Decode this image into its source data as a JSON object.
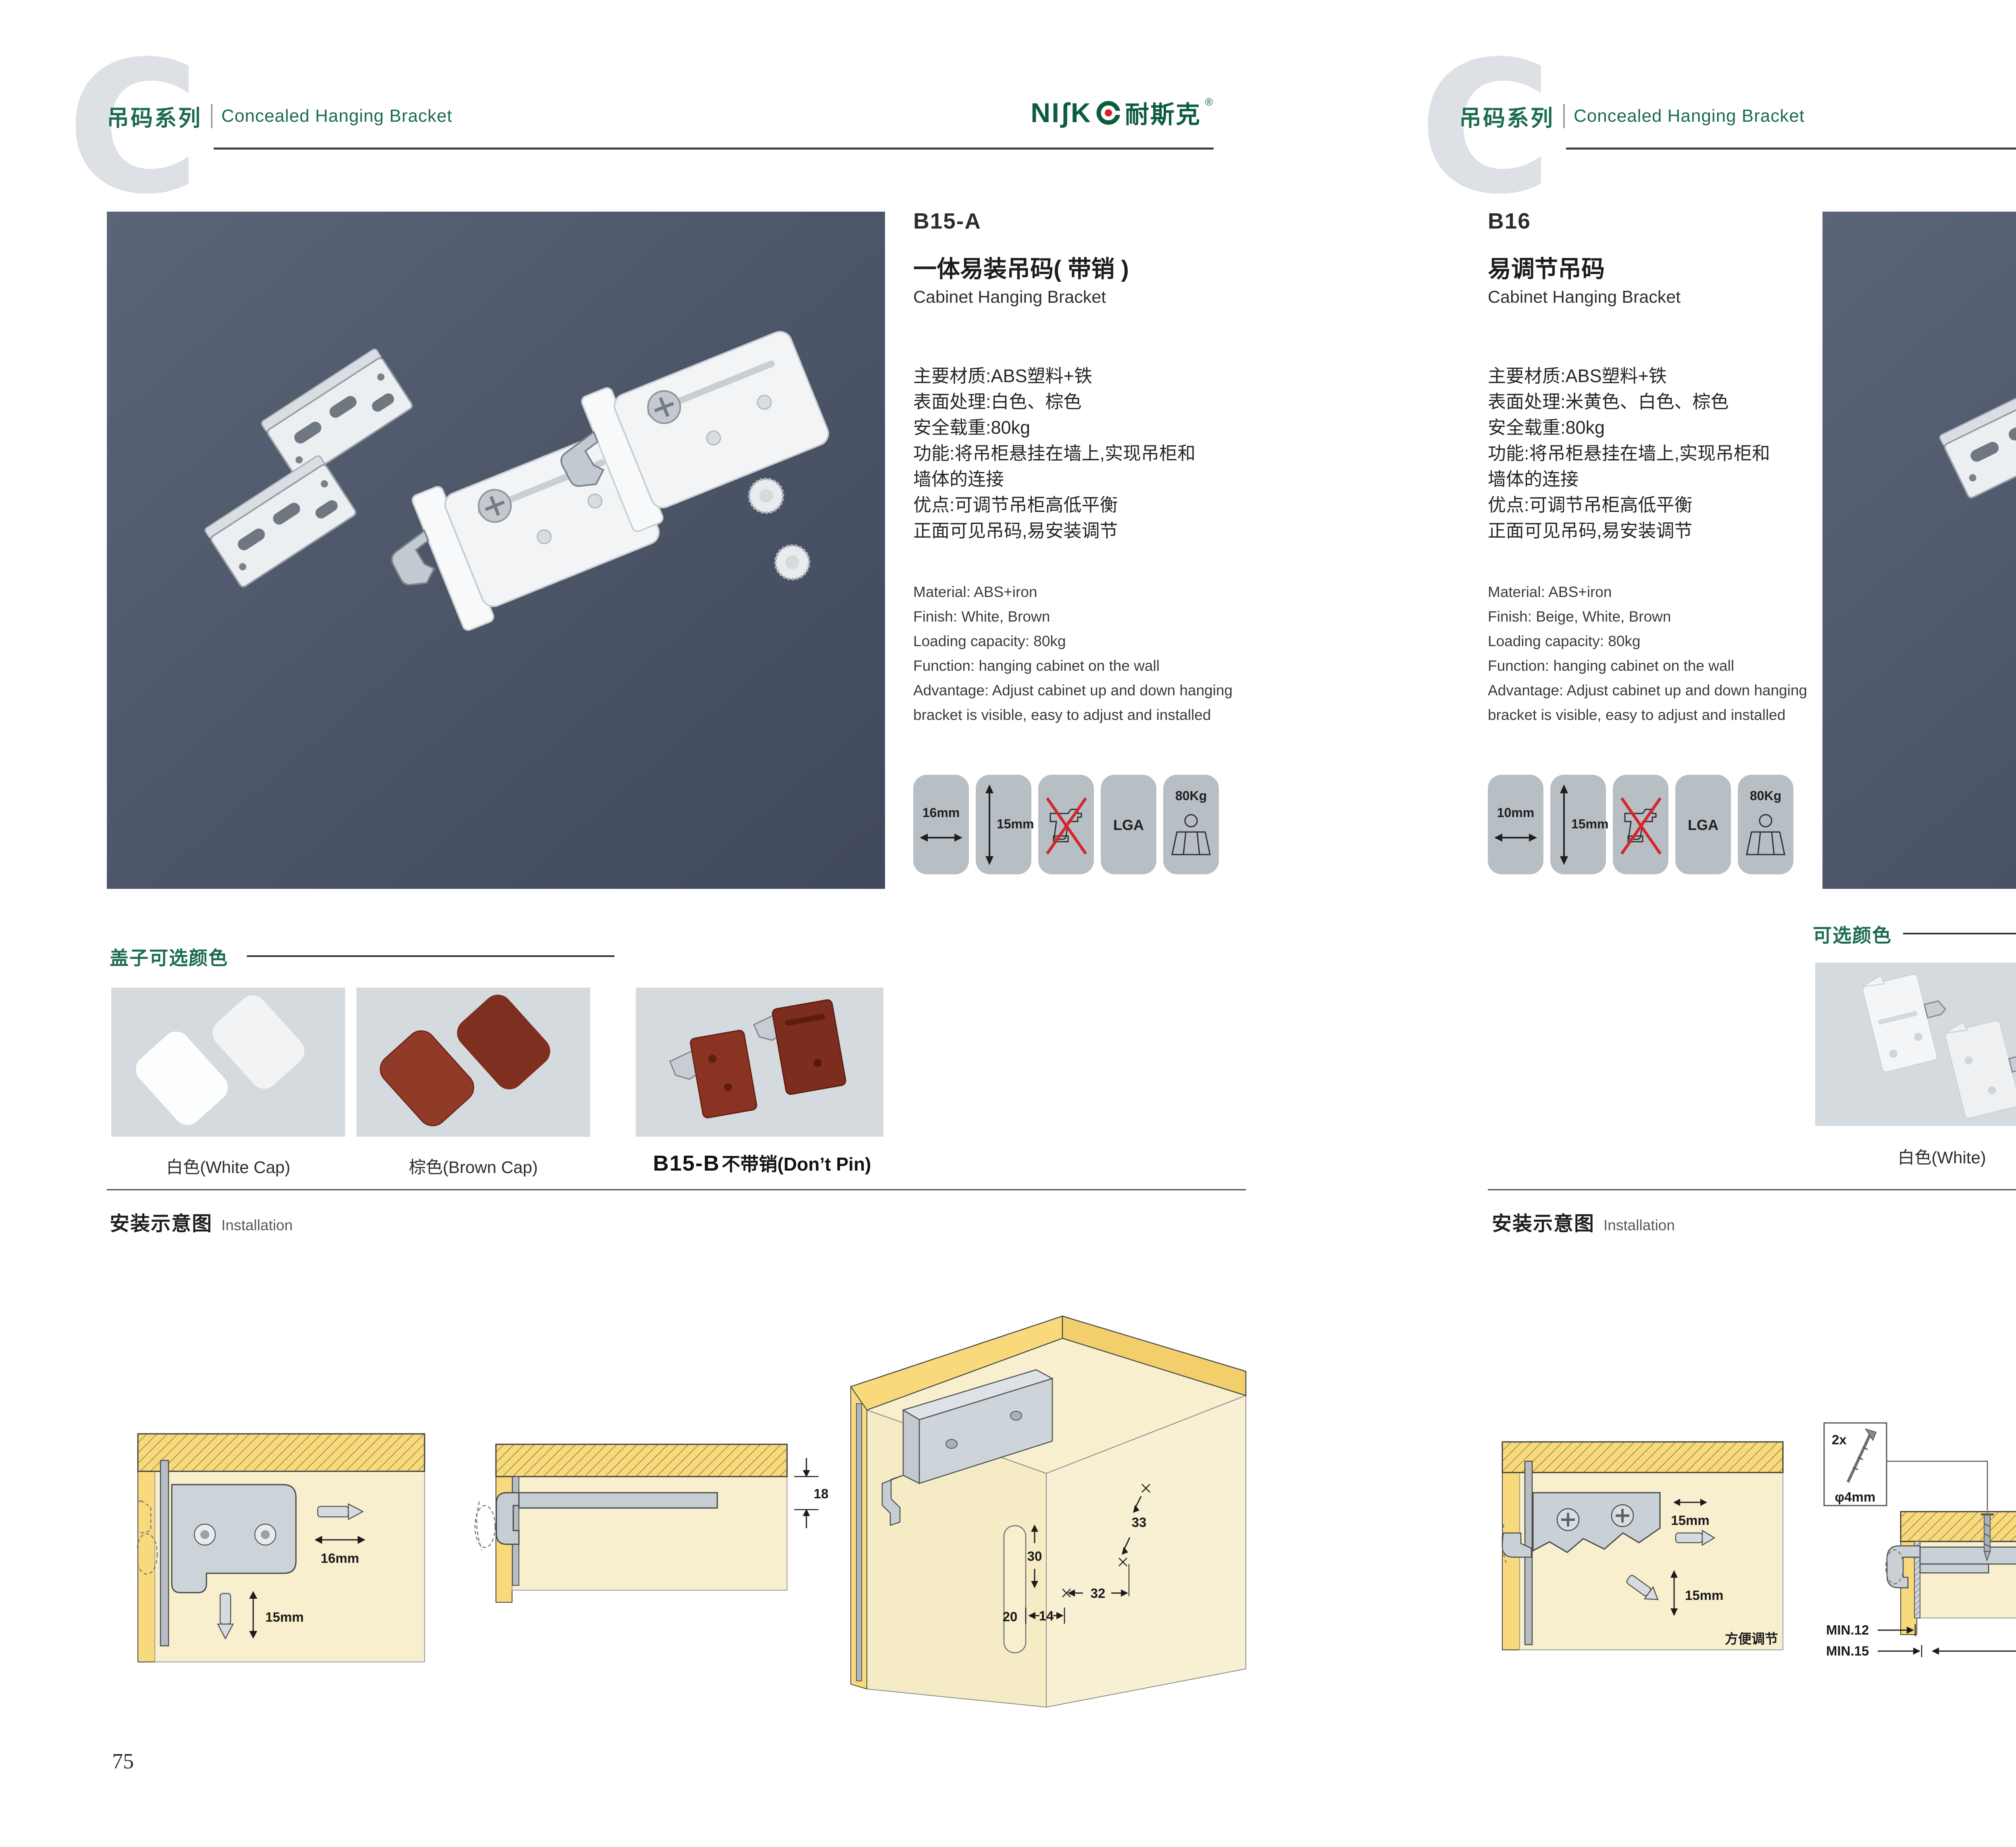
{
  "brand": {
    "logo_word": "NIʃK",
    "logo_cjk": "耐斯克",
    "logo_reg": "®"
  },
  "left_page": {
    "header": {
      "series_cn": "吊码系列",
      "series_en": "Concealed Hanging Bracket",
      "watermark": "C"
    },
    "product": {
      "code": "B15-A",
      "name_cn": "一体易装吊码( 带销 )",
      "name_en": "Cabinet Hanging Bracket",
      "specs_cn": [
        "主要材质:ABS塑料+铁",
        "表面处理:白色、棕色",
        "安全载重:80kg",
        "功能:将吊柜悬挂在墙上,实现吊柜和",
        "墙体的连接",
        "优点:可调节吊柜高低平衡",
        "正面可见吊码,易安装调节"
      ],
      "specs_en": [
        "Material: ABS+iron",
        "Finish: White, Brown",
        "Loading capacity: 80kg",
        "Function: hanging cabinet on the wall",
        "Advantage: Adjust cabinet up and down hanging",
        "bracket is visible, easy to adjust and installed"
      ]
    },
    "icons": {
      "width": "16mm",
      "height": "15mm",
      "cert": "LGA",
      "load": "80Kg"
    },
    "colors_section": {
      "title": "盖子可选颜色",
      "caption_1": "白色(White Cap)",
      "caption_2": "棕色(Brown Cap)",
      "caption_3_code": "B15-B",
      "caption_3": "不带销(Don’t Pin)"
    },
    "installation": {
      "title_cn": "安装示意图",
      "title_en": "Installation",
      "d1_w": "16mm",
      "d1_h": "15mm",
      "d2": "18",
      "d3_a": "33",
      "d3_b": "30",
      "d3_c": "32",
      "d3_d": "20",
      "d3_e": "14"
    },
    "page_number": "75"
  },
  "right_page": {
    "header": {
      "series_cn": "吊码系列",
      "series_en": "Concealed Hanging Bracket",
      "watermark": "C"
    },
    "product": {
      "code": "B16",
      "name_cn": "易调节吊码",
      "name_en": "Cabinet Hanging Bracket",
      "specs_cn": [
        "主要材质:ABS塑料+铁",
        "表面处理:米黄色、白色、棕色",
        "安全载重:80kg",
        "功能:将吊柜悬挂在墙上,实现吊柜和",
        "墙体的连接",
        "优点:可调节吊柜高低平衡",
        "正面可见吊码,易安装调节"
      ],
      "specs_en": [
        "Material: ABS+iron",
        "Finish: Beige, White, Brown",
        "Loading capacity: 80kg",
        "Function: hanging cabinet on the wall",
        "Advantage: Adjust cabinet up and down hanging",
        "bracket is visible, easy to adjust and installed"
      ]
    },
    "icons": {
      "width": "10mm",
      "height": "15mm",
      "cert": "LGA",
      "load": "80Kg"
    },
    "colors_section": {
      "title": "可选颜色",
      "caption_1": "白色(White)",
      "caption_2": "棕色(Brown )",
      "caption_3": "米黄色 (Beige)"
    },
    "installation": {
      "title_cn": "安装示意图",
      "title_en": "Installation",
      "d1_w": "15mm",
      "d1_h": "15mm",
      "d1_note": "方便调节",
      "d2_qty": "2x",
      "d2_dia": "φ4mm",
      "d2_dim": "19",
      "d2_min1": "MIN.12",
      "d2_min2": "MIN.15",
      "d3_a": "30",
      "d3_b": "32",
      "d3_r": "RMAX4",
      "d3_c": "19",
      "d3_d": "20",
      "d3_e": "32"
    },
    "page_number": "76"
  }
}
